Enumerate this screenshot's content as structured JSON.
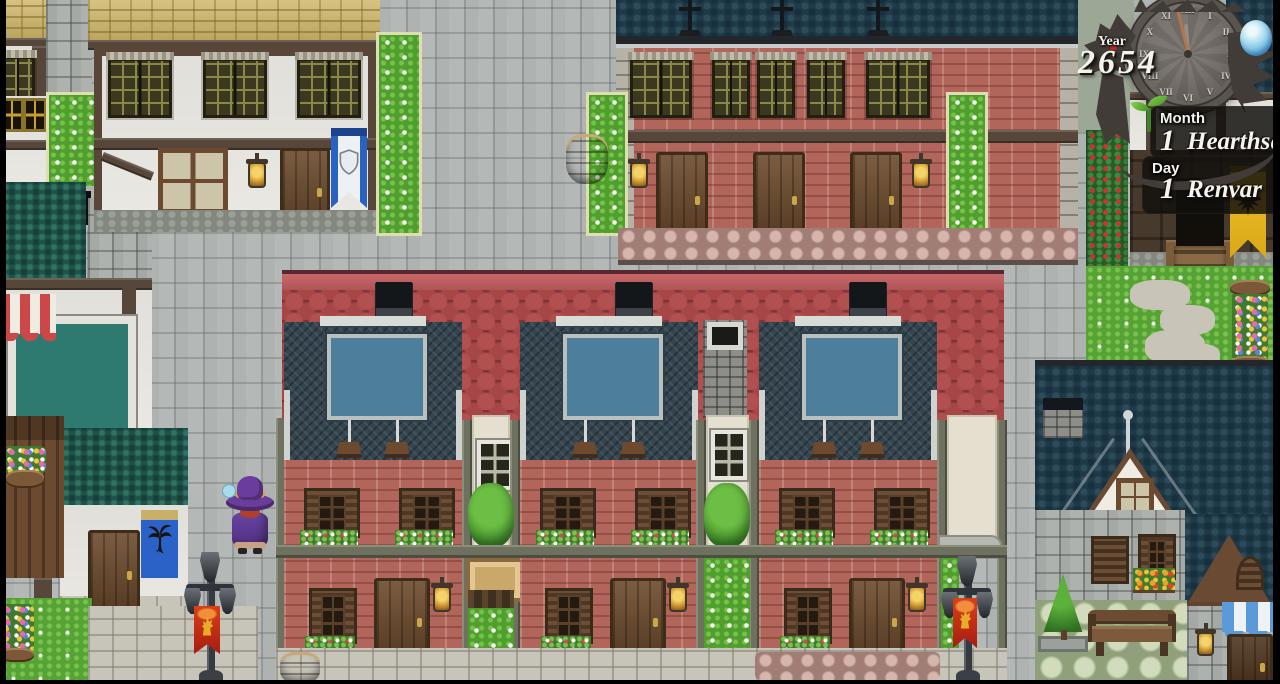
{
  "hud": {
    "year": {
      "label": "Year",
      "value": "2654"
    },
    "calendar": {
      "month_label": "Month",
      "month_number": "1",
      "month_name": "Hearthseek",
      "day_label": "Day",
      "day_number": "1",
      "day_name": "Renvar"
    },
    "clock": {
      "style": "dragon-wrapped-stone-clock",
      "numerals": [
        "XII",
        "I",
        "II",
        "III",
        "IV",
        "V",
        "VI",
        "VII",
        "VIII",
        "IX",
        "X",
        "XI"
      ],
      "minute_hand_color": "#b5744c",
      "hour_hand_color": "#958e86"
    },
    "season_icon": "sprout-icon",
    "weather_icon": "water-drop-icon",
    "panel_color": "rgba(18,15,12,0.84)",
    "text_color": "#f6f3ec"
  },
  "scene": {
    "player": {
      "sprite": "purple-mage",
      "hat_color": "#6a3d9c",
      "robe_color": "#5e3a96",
      "facing": "up"
    },
    "palette": {
      "street": "#aeb3b1",
      "brick": "#b2655a",
      "red_roof": "#a84a4a",
      "navy_roof": "#1f3947",
      "slate_roof": "#35454f",
      "teal_roof": "#1e5248",
      "yellow_roof": "#cdb668",
      "plaster": "#eae8e2",
      "grass": "#55a334",
      "awning_panel": "#4d7e9b",
      "timber": "#57473b"
    },
    "banners": {
      "shield_banner": "#2a62c0",
      "plant_banner": "#2a62c8",
      "eagle_banner": "#e8b820",
      "lion_banner": "#c02818"
    }
  }
}
